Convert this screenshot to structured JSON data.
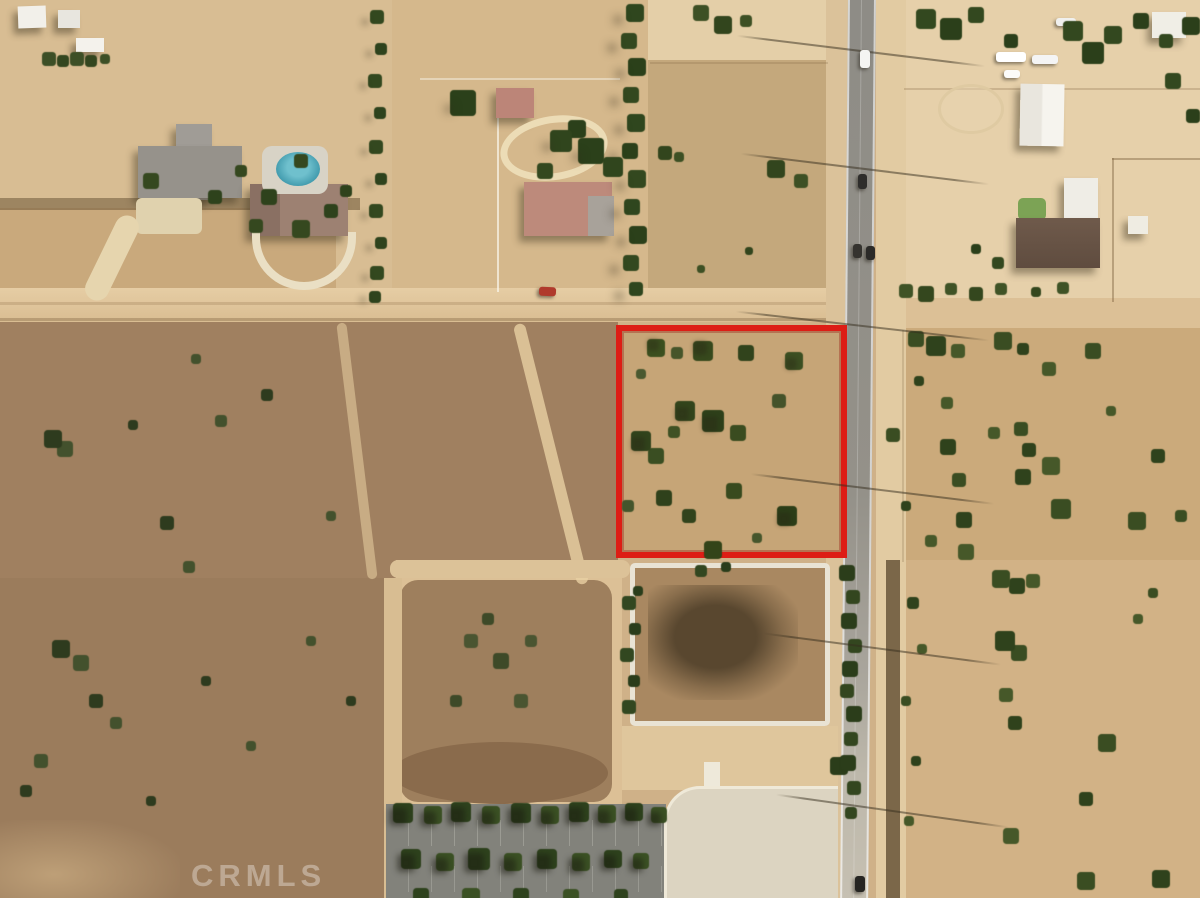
{
  "image": {
    "type": "aerial-photograph",
    "description": "Overhead view of high-desert residential acreage: a vacant square lot outlined in red next to a two-lane paved road, an east-west dirt road above it, ranch homes with a pool along the top, a white-fenced brush lot and tree-lined parking lot below, and open tan/brown scrub fields left and right.",
    "watermark": "CRMLS"
  },
  "colors": {
    "parcel_outline_red": "#dd1d15",
    "asphalt_gray": "#8f8d87",
    "road_shoulder_sand": "#dfc79f",
    "dirt_road_tan": "#e2c89e",
    "scrub_brown": "#9d7d5c",
    "field_tan": "#cbaa7b",
    "tree_green": "#33481f",
    "pool_teal": "#3e98ab",
    "white_fence": "#e9e3d4",
    "parking_asphalt": "#82827b",
    "concrete_light": "#dcd4c1"
  },
  "scene": {
    "outlined_vacant_lot": "red-outlined vacant desert lot with scattered juniper shrubs",
    "paved_road": "two-lane road running north-south with cars and power-line crossings",
    "dirt_cross_road": "unpaved road running east-west above the outlined lot",
    "fenced_brush_lot": "white-bordered lot of dark brush with street trees, below the outlined lot",
    "parking_lot": "tree-lined asphalt parking lot at bottom center with concrete apron",
    "homes_top_left": "ranch homes with gray roof, swimming pool and driveways",
    "homes_top_middle": "homes with pink roofs and circular driveway, red car on dirt road",
    "horse_property_top_right": "sandy lot with barn, trailers, round pen and brown-roofed house",
    "open_desert_left": "dark brown scrub field",
    "open_desert_right": "tan fields dotted with shrubs"
  }
}
